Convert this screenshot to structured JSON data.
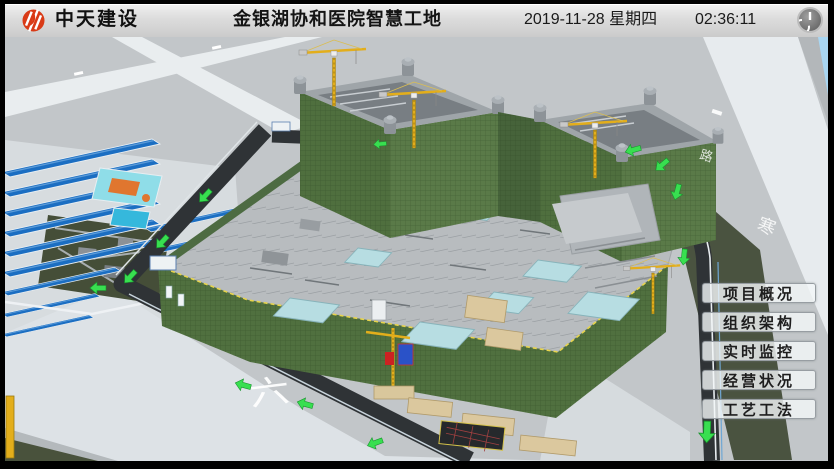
{
  "header": {
    "logo_text": "中天建设",
    "title": "金银湖协和医院智慧工地",
    "date": "2019-11-28 星期四",
    "time": "02:36:11"
  },
  "menu": {
    "items": [
      {
        "label": "项目概况"
      },
      {
        "label": "组织架构"
      },
      {
        "label": "实时监控"
      },
      {
        "label": "经营状况"
      },
      {
        "label": "工艺工法"
      }
    ]
  },
  "scene": {
    "road_labels": [
      "六",
      "路",
      "寒"
    ]
  },
  "icons": {
    "power": "power-symbol-circle-with-bar",
    "logo": "red-circle-monogram",
    "direction_arrow": "green-up-arrow"
  },
  "colors": {
    "header_bg": "#dcdcdc",
    "logo_red": "#d93a16",
    "arrow_green": "#38df50",
    "netting_green": "#50703f",
    "dorm_roof_blue": "#1b6ec2",
    "crane_yellow": "#e3ae1b",
    "dark_road": "#2f3336",
    "button_bg": "rgba(244,247,249,0.80)"
  }
}
